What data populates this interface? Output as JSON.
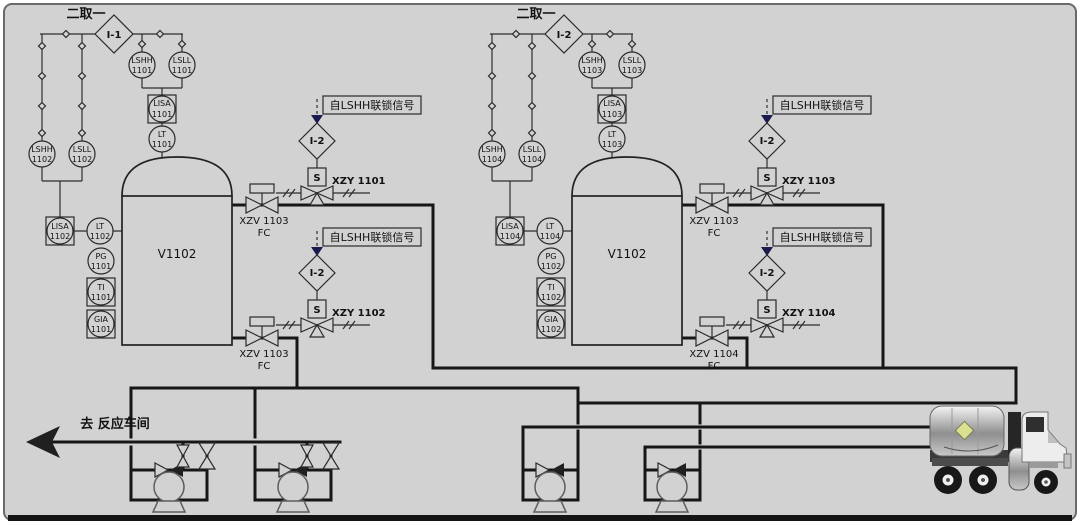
{
  "colors": {
    "canvas_bg": "#d2d2d2",
    "pipe_line": "#161616",
    "signal_line": "#2e2e2e",
    "interlock_arrow": "#1b1b50",
    "hazard_placard": "#d9e08f",
    "border": "#6a6a6a"
  },
  "units": [
    {
      "voting_label": "二取一",
      "voting_tag": "I-1",
      "lshh_a": {
        "t": "LSHH",
        "n": "1101"
      },
      "lsll_a": {
        "t": "LSLL",
        "n": "1101"
      },
      "lisa_a": {
        "t": "LISA",
        "n": "1101"
      },
      "lt_a": {
        "t": "LT",
        "n": "1101"
      },
      "lshh_b": {
        "t": "LSHH",
        "n": "1102"
      },
      "lsll_b": {
        "t": "LSLL",
        "n": "1102"
      },
      "lisa_b": {
        "t": "LISA",
        "n": "1102"
      },
      "lt_b": {
        "t": "LT",
        "n": "1102"
      },
      "pg": {
        "t": "PG",
        "n": "1101"
      },
      "ti": {
        "t": "TI",
        "n": "1101"
      },
      "gia": {
        "t": "GIA",
        "n": "1101"
      },
      "vessel": "V1102",
      "chain_top": {
        "signal": "自LSHH联锁信号",
        "interlock": "I-2",
        "sol": "S",
        "xzy": "XZY 1101",
        "xzv": "XZV 1103",
        "fc": "FC"
      },
      "chain_bottom": {
        "signal": "自LSHH联锁信号",
        "interlock": "I-2",
        "sol": "S",
        "xzy": "XZY 1102",
        "xzv": "XZV 1103",
        "fc": "FC"
      }
    },
    {
      "voting_label": "二取一",
      "voting_tag": "I-2",
      "lshh_a": {
        "t": "LSHH",
        "n": "1103"
      },
      "lsll_a": {
        "t": "LSLL",
        "n": "1103"
      },
      "lisa_a": {
        "t": "LISA",
        "n": "1103"
      },
      "lt_a": {
        "t": "LT",
        "n": "1103"
      },
      "lshh_b": {
        "t": "LSHH",
        "n": "1104"
      },
      "lsll_b": {
        "t": "LSLL",
        "n": "1104"
      },
      "lisa_b": {
        "t": "LISA",
        "n": "1104"
      },
      "lt_b": {
        "t": "LT",
        "n": "1104"
      },
      "pg": {
        "t": "PG",
        "n": "1102"
      },
      "ti": {
        "t": "TI",
        "n": "1102"
      },
      "gia": {
        "t": "GIA",
        "n": "1102"
      },
      "vessel": "V1102",
      "chain_top": {
        "signal": "自LSHH联锁信号",
        "interlock": "I-2",
        "sol": "S",
        "xzy": "XZY 1103",
        "xzv": "XZV 1103",
        "fc": "FC"
      },
      "chain_bottom": {
        "signal": "自LSHH联锁信号",
        "interlock": "I-2",
        "sol": "S",
        "xzy": "XZY 1104",
        "xzv": "XZV 1104",
        "fc": "FC"
      }
    }
  ],
  "footer": {
    "destination": "去 反应车间"
  }
}
